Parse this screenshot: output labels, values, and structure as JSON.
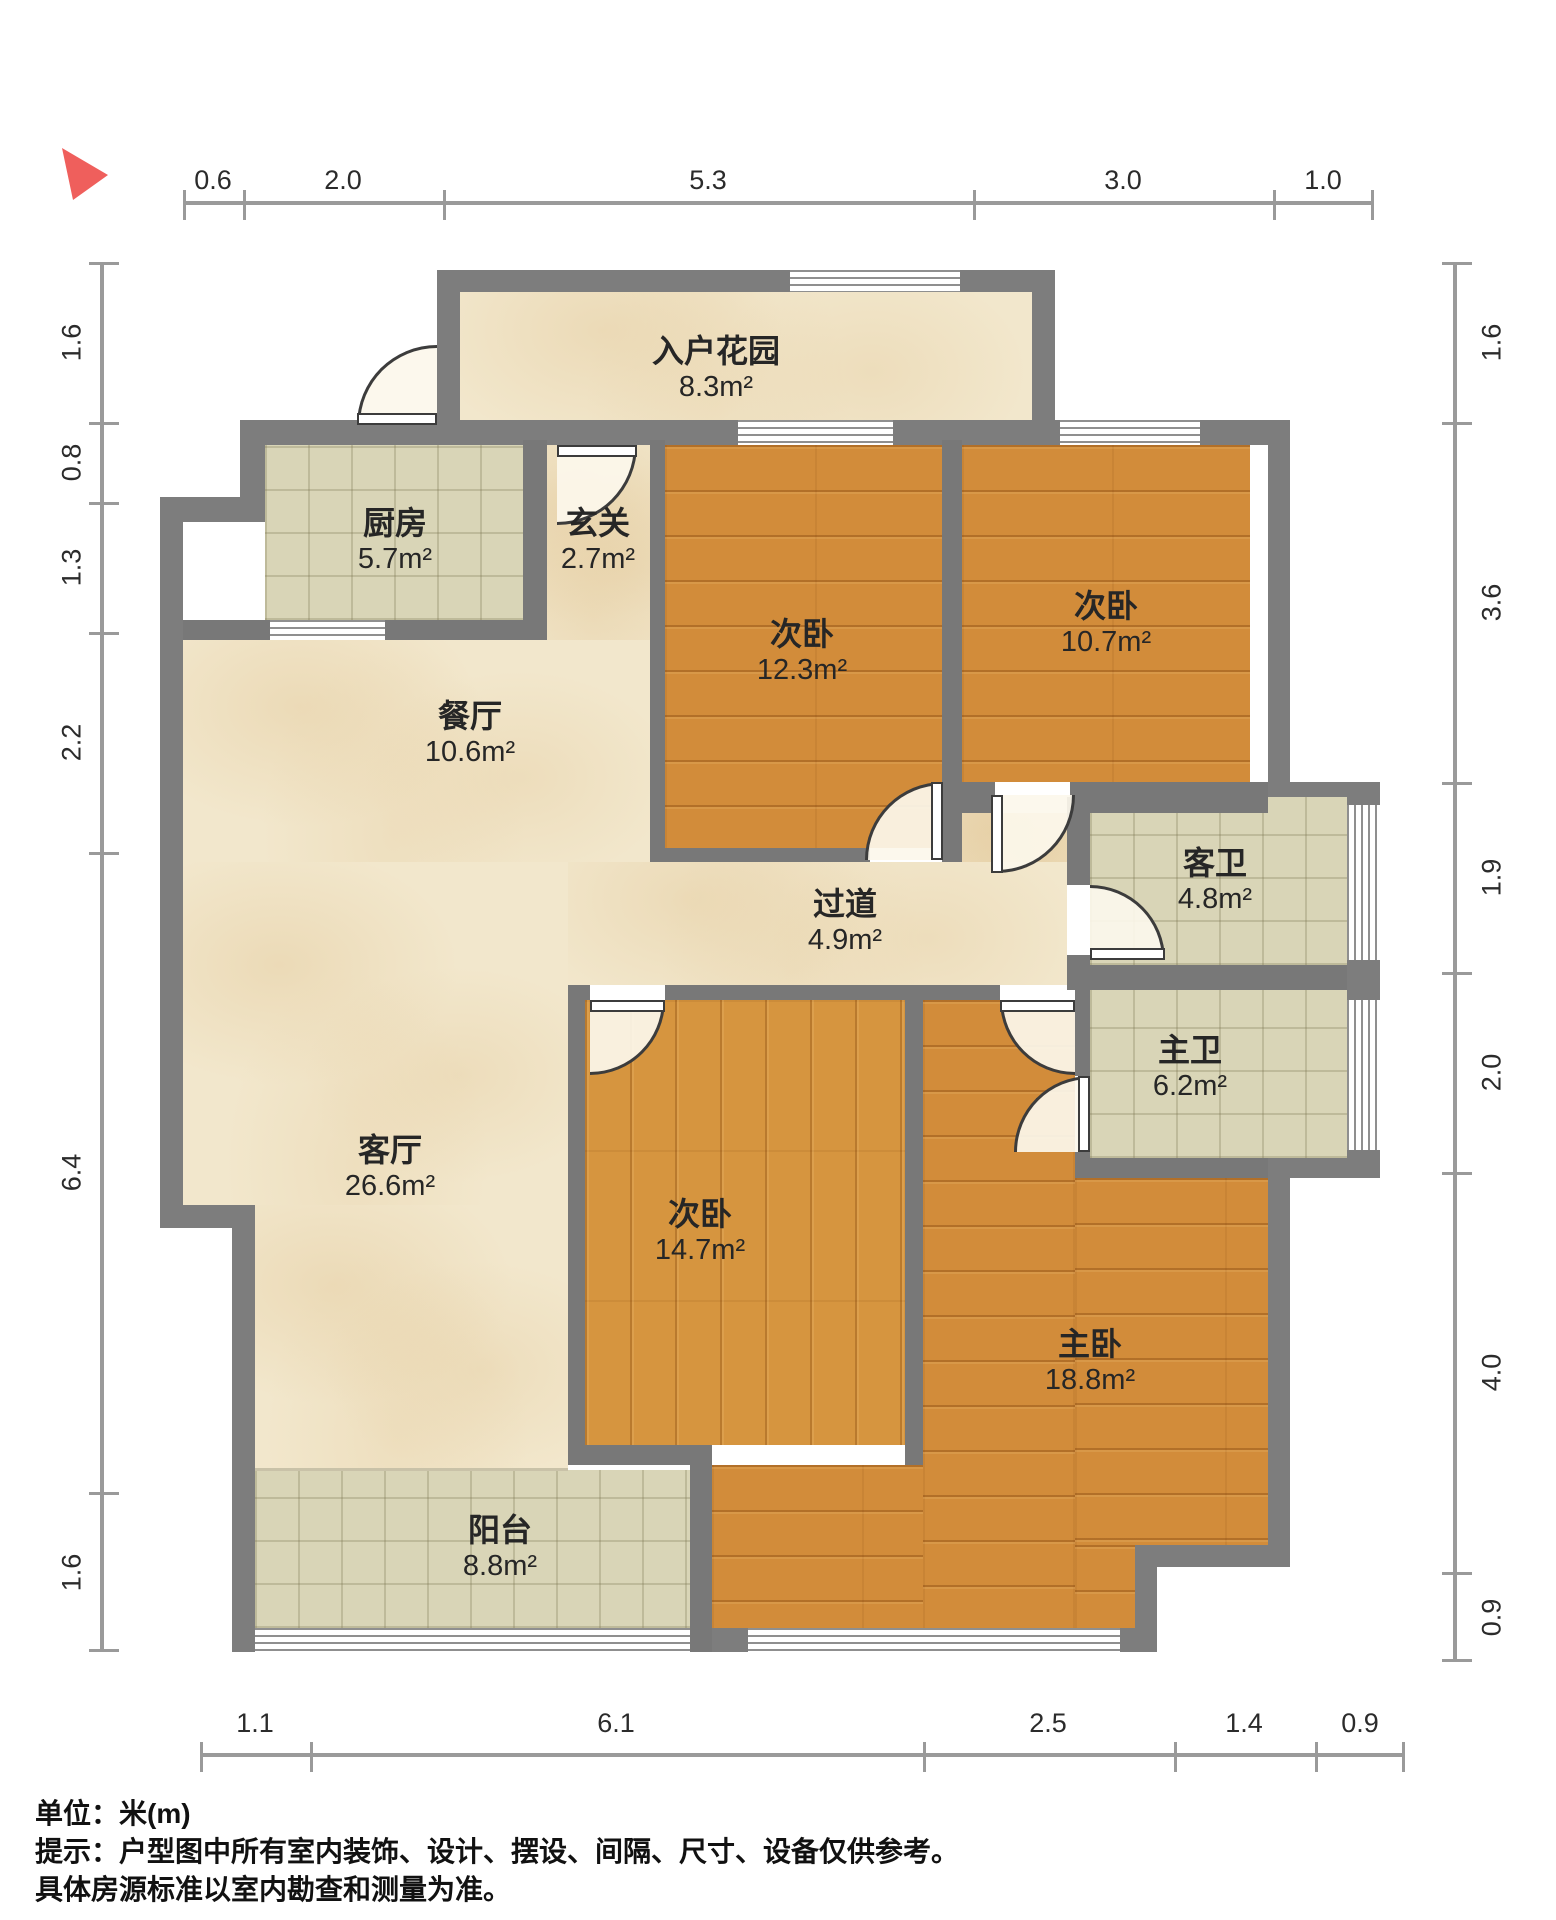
{
  "rooms": [
    {
      "id": "entry-garden",
      "name": "入户花园",
      "area": "8.3m²"
    },
    {
      "id": "kitchen",
      "name": "厨房",
      "area": "5.7m²"
    },
    {
      "id": "entry-hall",
      "name": "玄关",
      "area": "2.7m²"
    },
    {
      "id": "bedroom-a",
      "name": "次卧",
      "area": "12.3m²"
    },
    {
      "id": "bedroom-b",
      "name": "次卧",
      "area": "10.7m²"
    },
    {
      "id": "dining-room",
      "name": "餐厅",
      "area": "10.6m²"
    },
    {
      "id": "corridor",
      "name": "过道",
      "area": "4.9m²"
    },
    {
      "id": "guest-bathroom",
      "name": "客卫",
      "area": "4.8m²"
    },
    {
      "id": "master-bathroom",
      "name": "主卫",
      "area": "6.2m²"
    },
    {
      "id": "living-room",
      "name": "客厅",
      "area": "26.6m²"
    },
    {
      "id": "bedroom-c",
      "name": "次卧",
      "area": "14.7m²"
    },
    {
      "id": "master-bedroom",
      "name": "主卧",
      "area": "18.8m²"
    },
    {
      "id": "balcony",
      "name": "阳台",
      "area": "8.8m²"
    }
  ],
  "rulers": {
    "top": [
      "0.6",
      "2.0",
      "5.3",
      "3.0",
      "1.0"
    ],
    "bottom": [
      "1.1",
      "6.1",
      "2.5",
      "1.4",
      "0.9"
    ],
    "left": [
      "1.6",
      "0.8",
      "1.3",
      "2.2",
      "6.4",
      "1.6"
    ],
    "right": [
      "1.6",
      "3.6",
      "1.9",
      "2.0",
      "4.0",
      "0.9"
    ]
  },
  "notes": {
    "unit_prefix": "单位：",
    "unit_value": "米(m)",
    "tip_line1": "提示：户型图中所有室内装饰、设计、摆设、间隔、尺寸、设备仅供参考。",
    "tip_line2": "具体房源标准以室内勘查和测量为准。"
  },
  "colors": {
    "wall": "#7d7d7d",
    "wood_floor": "#d28c3a",
    "tile_floor": "#d9d5b7",
    "marble_floor": "#f2e7cc",
    "compass": "#ef5f5c"
  }
}
